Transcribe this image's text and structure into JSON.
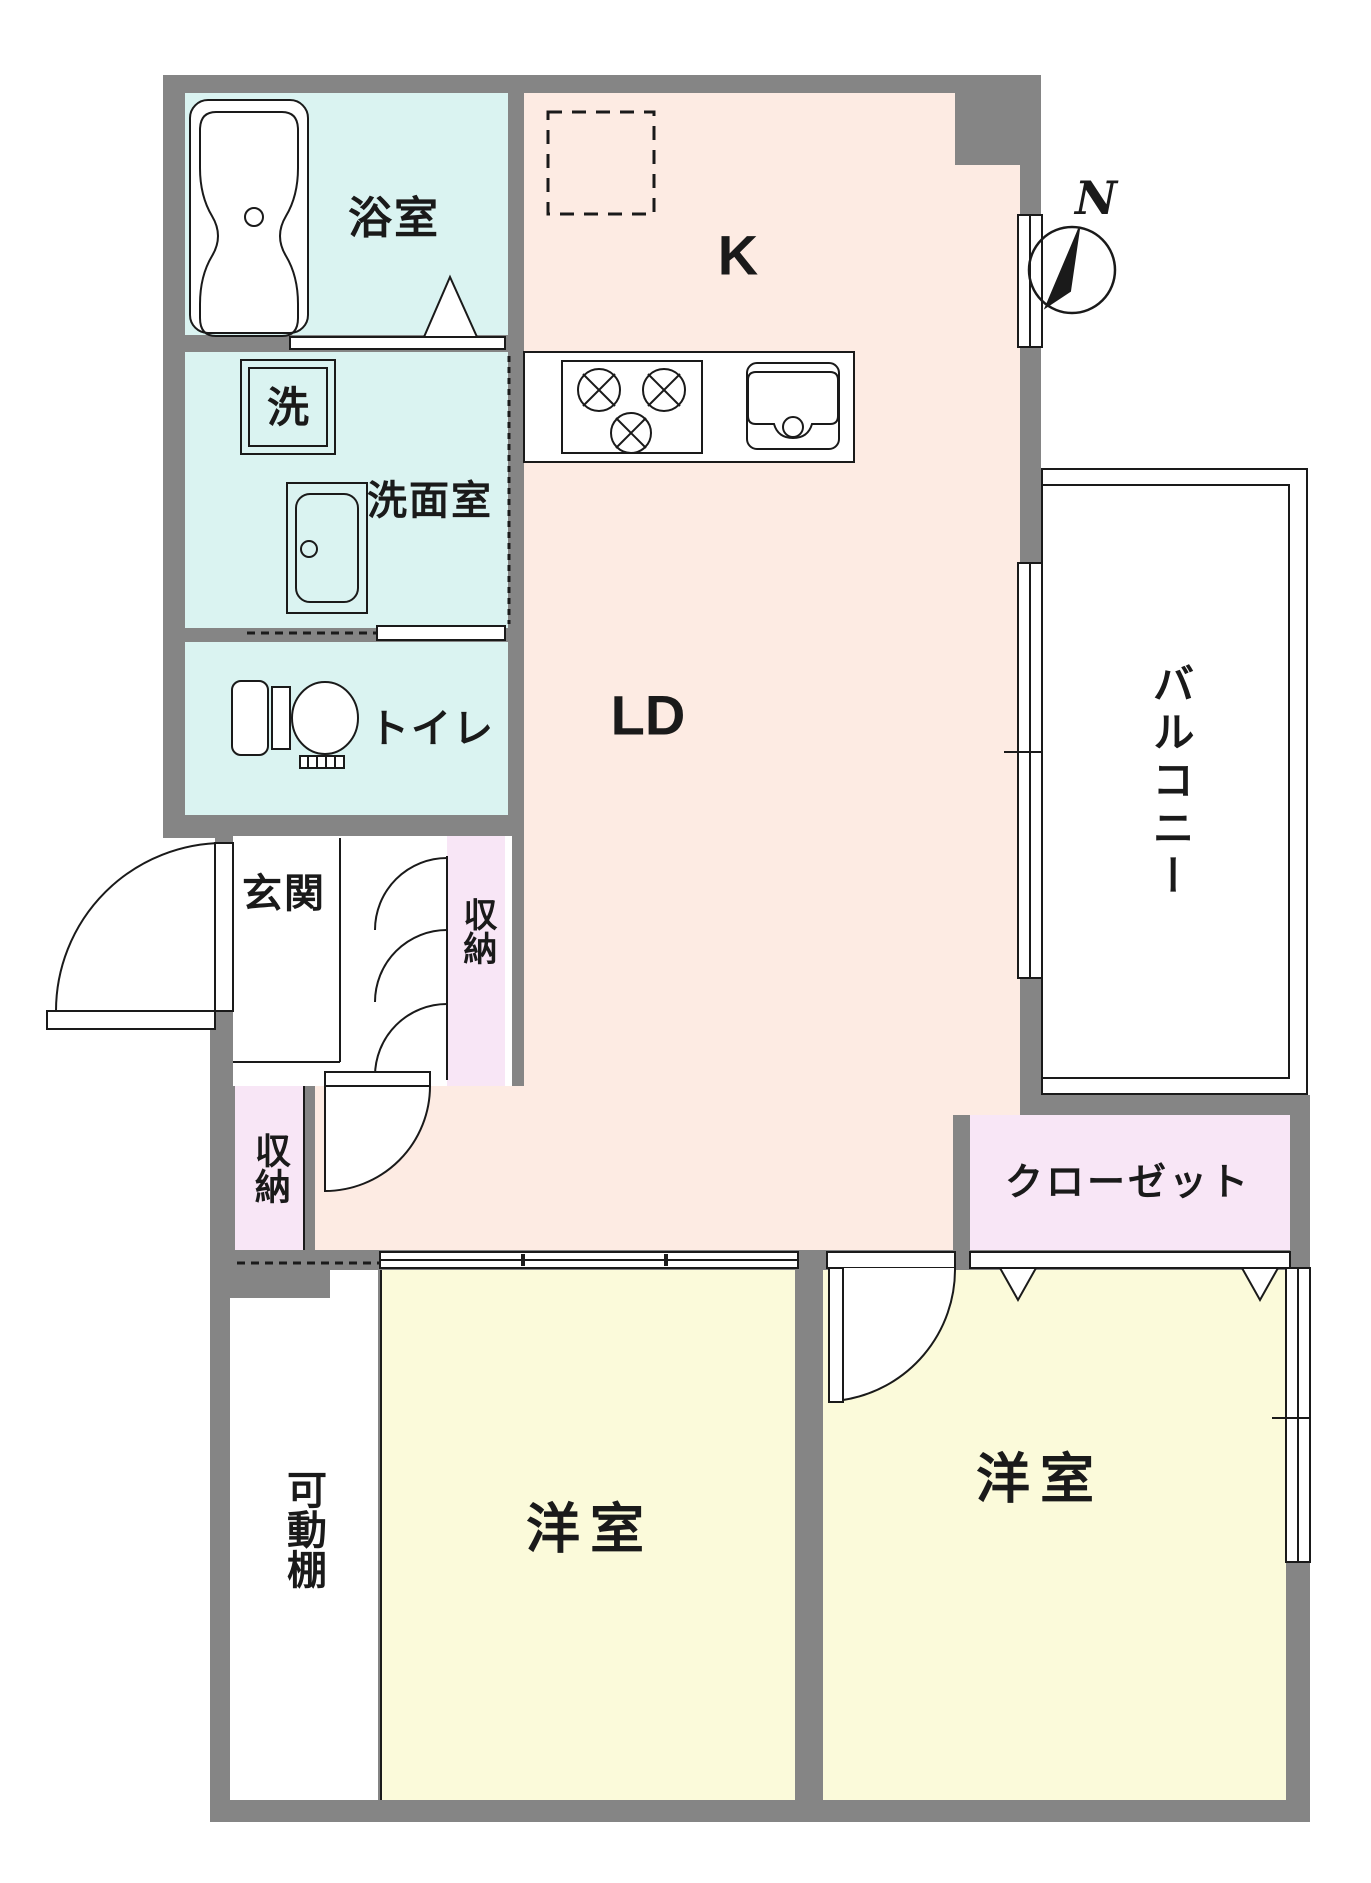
{
  "plan": {
    "type": "apartment-floorplan",
    "rooms": {
      "bath": {
        "label": "浴室"
      },
      "washer": {
        "label": "洗"
      },
      "washroom": {
        "label": "洗面室"
      },
      "toilet": {
        "label": "トイレ"
      },
      "entrance": {
        "label": "玄関"
      },
      "storage1": {
        "label": "収納"
      },
      "storage2": {
        "label": "収納"
      },
      "kitchen": {
        "label": "K"
      },
      "living": {
        "label": "LD"
      },
      "balcony": {
        "label": "バルコニー"
      },
      "closet": {
        "label": "クローゼット"
      },
      "shelf": {
        "label": "可動棚"
      },
      "bedroom1": {
        "label": "洋室"
      },
      "bedroom2": {
        "label": "洋室"
      }
    },
    "compass": {
      "label": "N"
    },
    "colors": {
      "wall": "#858585",
      "wet_rooms": "#daf3f1",
      "living_kitchen": "#fdebe3",
      "bedrooms": "#fbfada",
      "storage": "#f8e6f6",
      "line": "#1a1a1a"
    }
  }
}
